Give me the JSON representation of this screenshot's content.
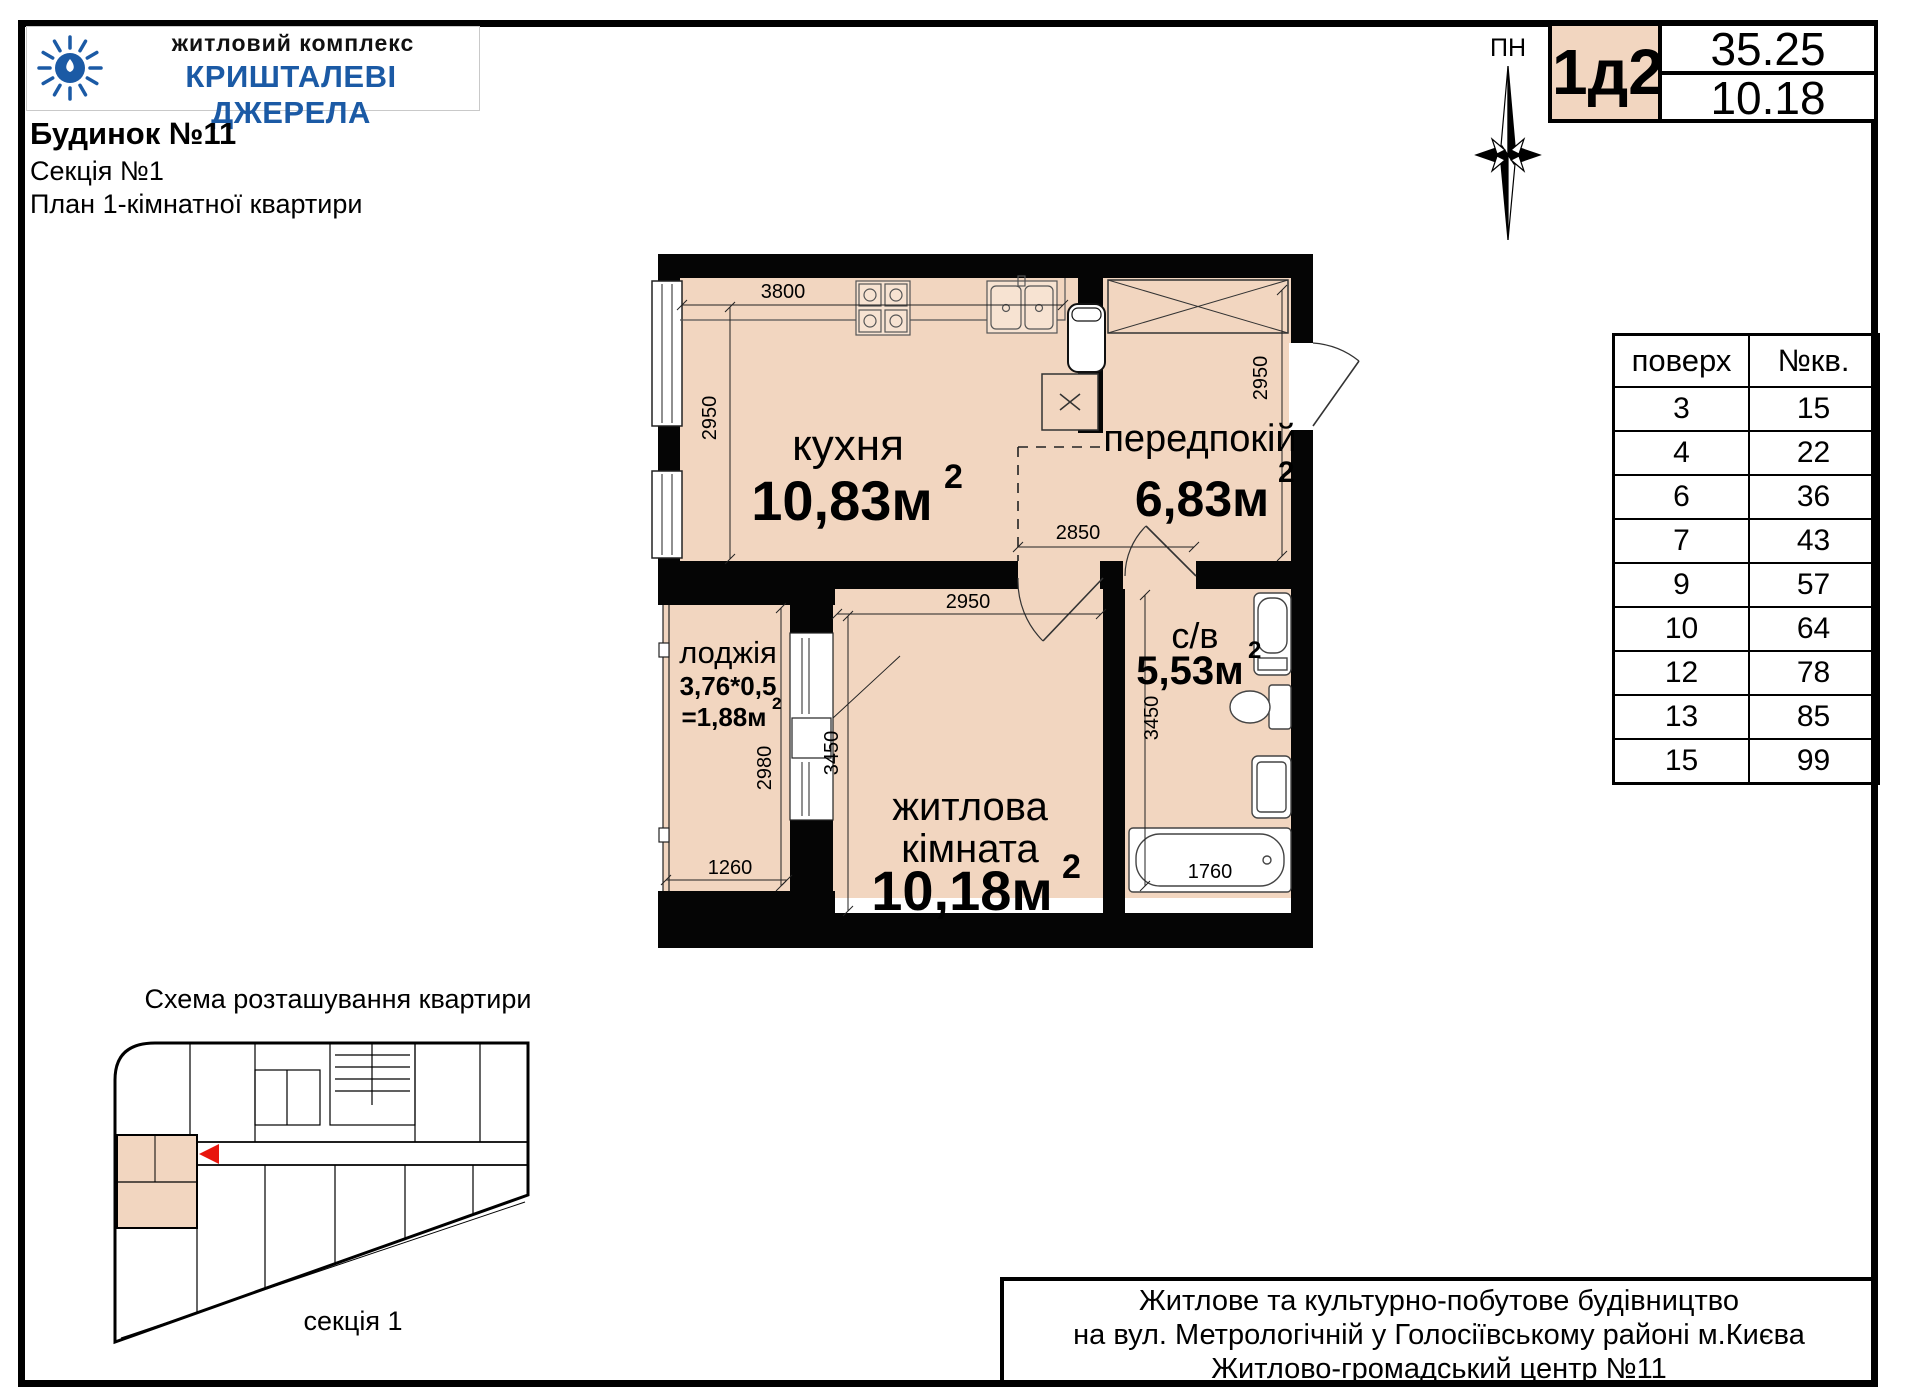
{
  "logo": {
    "line1": "житловий комплекс",
    "line2": "КРИШТАЛЕВІ ДЖЕРЕЛА"
  },
  "header": {
    "building": "Будинок №11",
    "section": "Секція №1",
    "plan_type": "План 1-кімнатної квартири"
  },
  "compass": {
    "label": "ПН"
  },
  "badge": {
    "code": "1д2",
    "total_area": "35.25",
    "living_area": "10.18"
  },
  "floors_table": {
    "col_floor": "поверх",
    "col_apt": "№кв.",
    "rows": [
      {
        "floor": "3",
        "apt": "15"
      },
      {
        "floor": "4",
        "apt": "22"
      },
      {
        "floor": "6",
        "apt": "36"
      },
      {
        "floor": "7",
        "apt": "43"
      },
      {
        "floor": "9",
        "apt": "57"
      },
      {
        "floor": "10",
        "apt": "64"
      },
      {
        "floor": "12",
        "apt": "78"
      },
      {
        "floor": "13",
        "apt": "85"
      },
      {
        "floor": "15",
        "apt": "99"
      }
    ]
  },
  "plan": {
    "sup": "2",
    "rooms": {
      "kitchen": {
        "name": "кухня",
        "area": "10,83м"
      },
      "hall": {
        "name": "передпокій",
        "area": "6,83м"
      },
      "loggia": {
        "name": "лоджія",
        "formula": "3,76*0,5",
        "area": "=1,88м"
      },
      "living": {
        "name1": "житлова",
        "name2": "кімната",
        "area": "10,18м"
      },
      "bath": {
        "name": "с/в",
        "area": "5,53м"
      }
    },
    "dims": {
      "kitchen_w": "3800",
      "kitchen_h": "2950",
      "hall_h": "2950",
      "hall_w": "2850",
      "living_w": "2950",
      "living_h": "3450",
      "bath_h": "3450",
      "bath_w": "1760",
      "loggia_h": "2980",
      "loggia_w": "1260"
    }
  },
  "scheme": {
    "title": "Схема розташування квартири",
    "caption": "секція 1"
  },
  "footer": {
    "line1": "Житлове та культурно-побутове будівництво",
    "line2": "на вул. Метрологічній у Голосіївському районі м.Києва",
    "line3": "Житлово-громадський центр №11"
  },
  "colors": {
    "room_fill": "#f2d6c0",
    "brand_blue": "#1b5aa5",
    "marker_red": "#e8150d",
    "wall_black": "#050505"
  }
}
